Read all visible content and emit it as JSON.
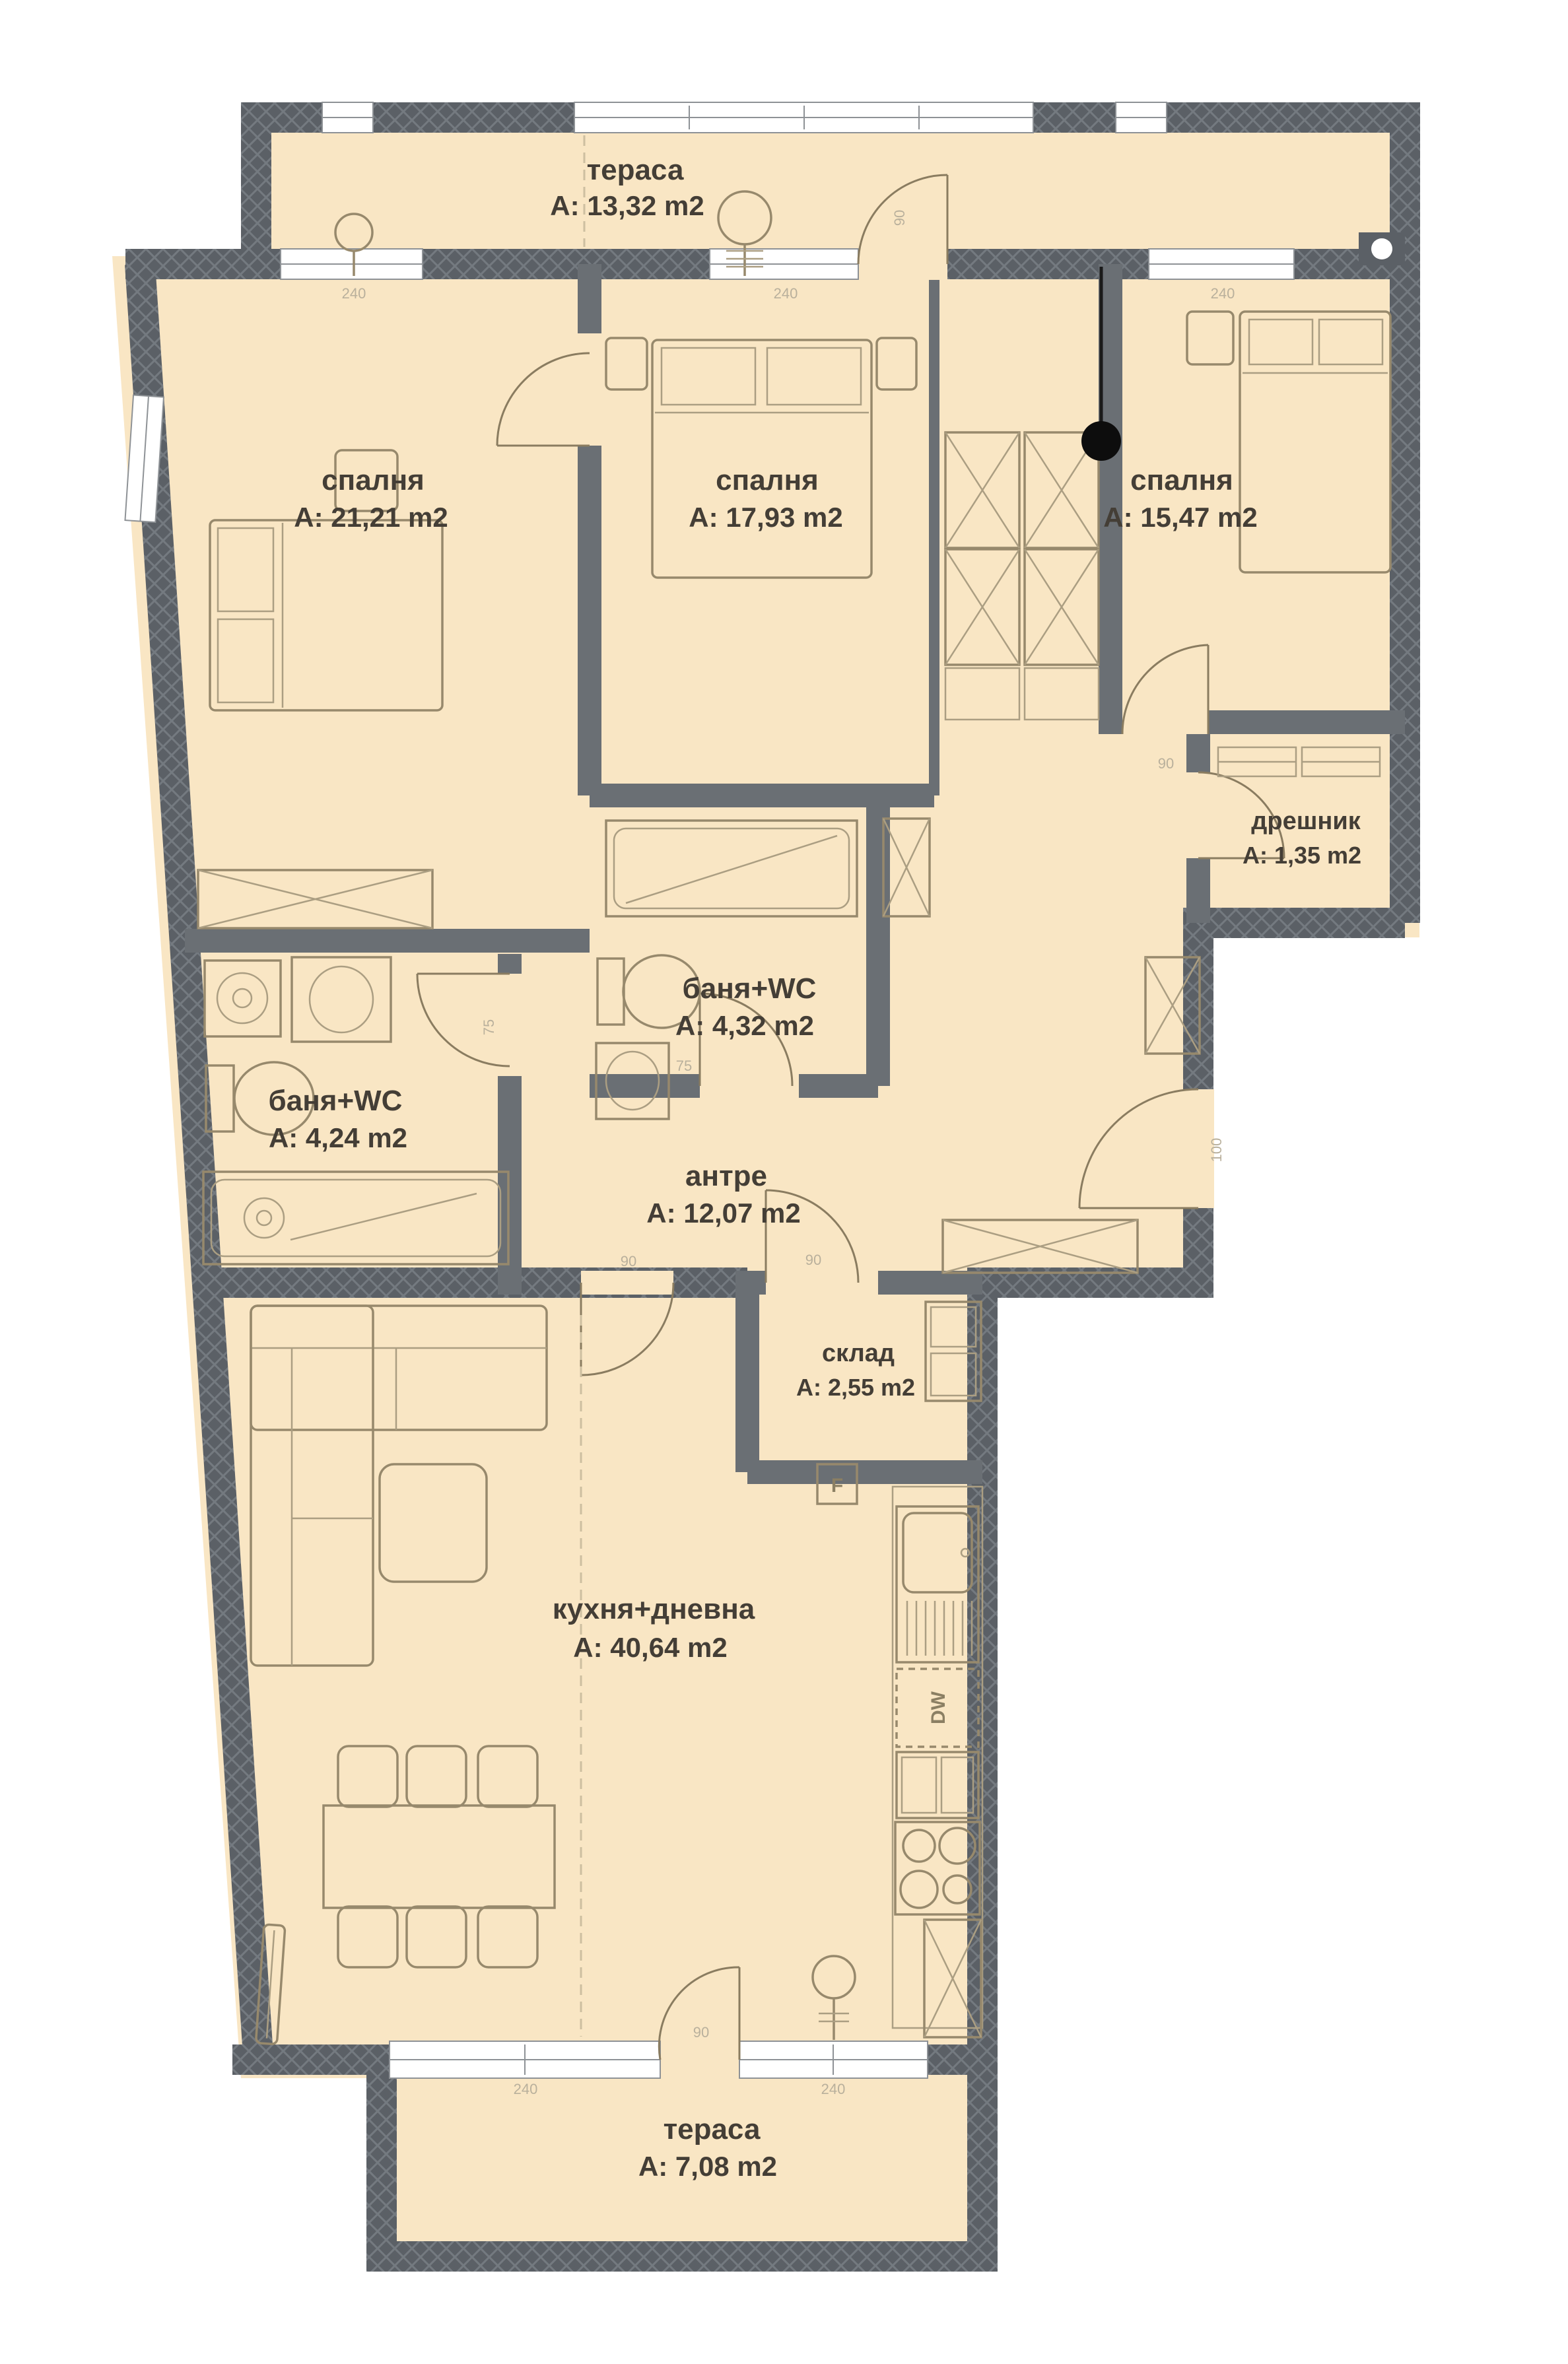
{
  "plan_type": "apartment floor plan",
  "rooms": [
    {
      "id": "terrace-top",
      "name": "тераса",
      "area": "A: 13,32 m2"
    },
    {
      "id": "bedroom-1",
      "name": "спалня",
      "area": "A: 21,21 m2"
    },
    {
      "id": "bedroom-2",
      "name": "спалня",
      "area": "A: 17,93 m2"
    },
    {
      "id": "bedroom-3",
      "name": "спалня",
      "area": "A: 15,47 m2"
    },
    {
      "id": "closet",
      "name": "дрешник",
      "area": "A: 1,35 m2"
    },
    {
      "id": "bath-1",
      "name": "баня+WC",
      "area": "A: 4,32 m2"
    },
    {
      "id": "bath-2",
      "name": "баня+WC",
      "area": "A: 4,24 m2"
    },
    {
      "id": "hallway",
      "name": "антре",
      "area": "A: 12,07 m2"
    },
    {
      "id": "storage",
      "name": "склад",
      "area": "A: 2,55 m2"
    },
    {
      "id": "kitchen-living",
      "name": "кухня+дневна",
      "area": "A: 40,64 m2"
    },
    {
      "id": "terrace-bottom",
      "name": "тераса",
      "area": "A: 7,08 m2"
    }
  ],
  "appliances": {
    "dishwasher": "DW",
    "fridge": "F"
  },
  "dims": [
    "240",
    "240",
    "240",
    "90",
    "90",
    "75",
    "75",
    "90",
    "90",
    "100",
    "90",
    "240",
    "240"
  ],
  "colors": {
    "floor": "#f9e6c4",
    "wall_exterior": "#5b6066",
    "wall_interior": "#6a6f74",
    "furniture_line": "#97896c",
    "label_text": "#443e36",
    "dim_text": "#b9b09c",
    "entrance_dot": "#0d0d0d",
    "background": "#ffffff"
  }
}
